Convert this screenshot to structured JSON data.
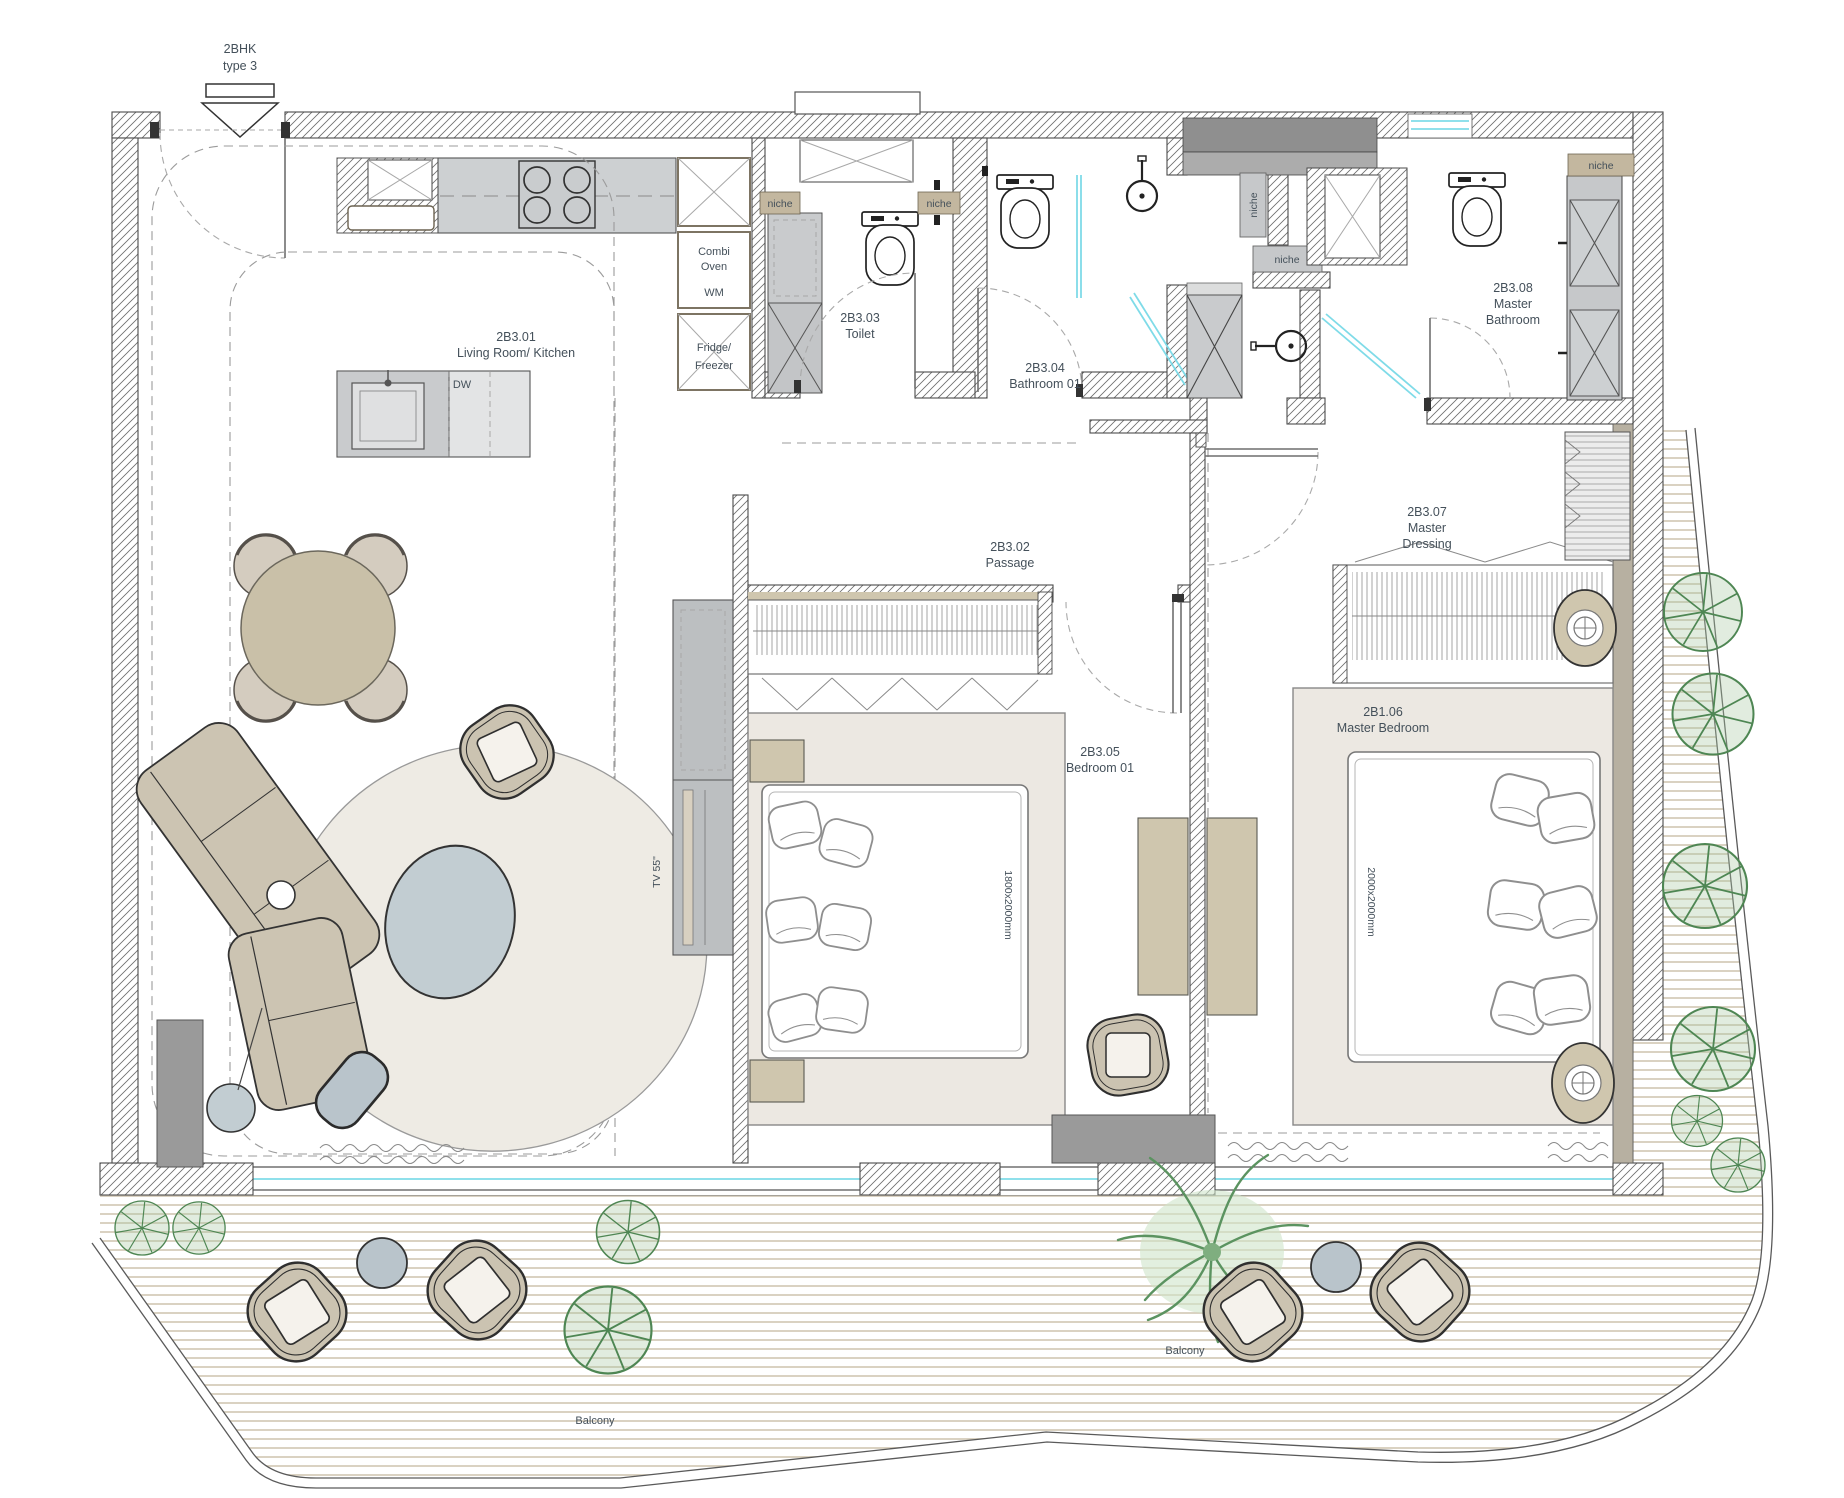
{
  "plan": {
    "unit": {
      "type": "2BHK",
      "subtype": "type 3"
    },
    "rooms": {
      "living": {
        "code": "2B3.01",
        "name": "Living Room/ Kitchen"
      },
      "passage": {
        "code": "2B3.02",
        "name": "Passage"
      },
      "toilet": {
        "code": "2B3.03",
        "name": "Toilet"
      },
      "bathroom01": {
        "code": "2B3.04",
        "name": "Bathroom 01"
      },
      "bedroom01": {
        "code": "2B3.05",
        "name": "Bedroom 01",
        "bed_size": "1800x2000mm"
      },
      "master_bedroom": {
        "code": "2B1.06",
        "name": "Master Bedroom",
        "bed_size": "2000x2000mm"
      },
      "master_dressing": {
        "code": "2B3.07",
        "line1": "Master",
        "line2": "Dressing"
      },
      "master_bathroom": {
        "code": "2B3.08",
        "line1": "Master",
        "line2": "Bathroom"
      },
      "balcony_left": {
        "name": "Balcony"
      },
      "balcony_right": {
        "name": "Balcony"
      }
    },
    "appliances": {
      "dishwasher": "DW",
      "combi_line1": "Combi",
      "combi_line2": "Oven",
      "washer": "WM",
      "fridge_line1": "Fridge/",
      "fridge_line2": "Freezer",
      "tv": "TV 55\""
    },
    "niche_label": "niche",
    "colors": {
      "wall_line": "#4a4a4a",
      "furniture_tan": "#cbc3b1",
      "cabinet_gray": "#c6c8ca",
      "dark_gray": "#9a9a9a",
      "rug_cream": "#edeae3",
      "accent_blue_gray": "#bfc9cf",
      "glass_cyan": "#7fdbe8",
      "plant_green": "#4e8653",
      "deck_line": "#d6cdbb",
      "text": "#44505a",
      "niche_tan": "#c3b79f"
    }
  }
}
